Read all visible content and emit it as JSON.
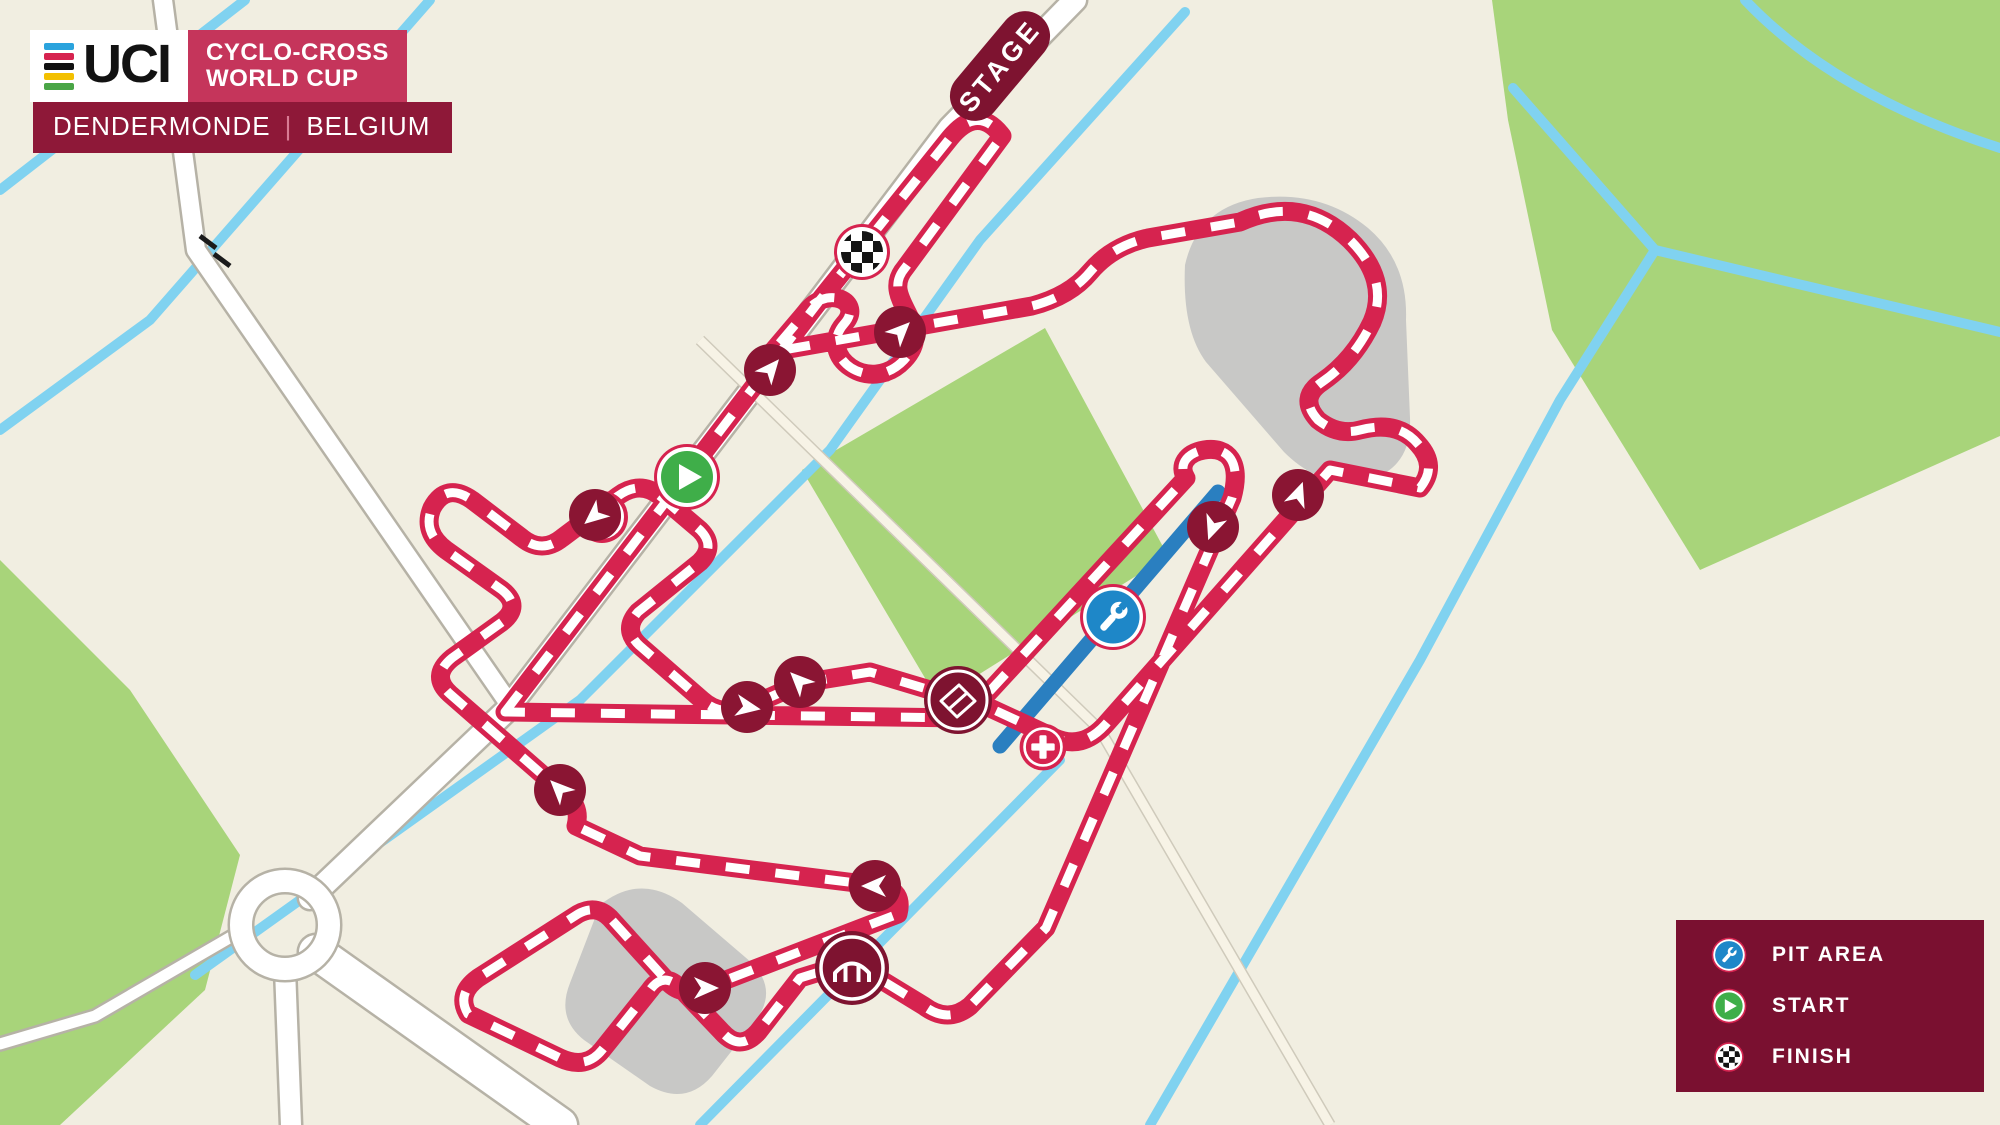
{
  "header": {
    "uci": "UCI",
    "series_line1": "CYCLO-CROSS",
    "series_line2": "WORLD CUP",
    "location": "DENDERMONDE",
    "separator": "|",
    "country": "BELGIUM",
    "stripe_colors": [
      "#2aa3dd",
      "#d6234f",
      "#111111",
      "#f3c000",
      "#4aa546"
    ]
  },
  "stage_label": "STAGE",
  "legend": {
    "items": [
      {
        "icon": "pit-area-icon",
        "type": "pit",
        "label": "PIT AREA"
      },
      {
        "icon": "start-icon",
        "type": "start",
        "label": "START"
      },
      {
        "icon": "finish-icon",
        "type": "finish",
        "label": "FINISH"
      }
    ]
  },
  "colors": {
    "bg": "#f1eee1",
    "field": "#a8d47a",
    "water": "#80d2f0",
    "sand": "#c8c8c6",
    "road_fill": "#ffffff",
    "road_casing": "#b6b2a6",
    "path_fill": "#f7f3e6",
    "path_casing": "#cfcabb",
    "course": "#d6234f",
    "course_dash": "#ffffff",
    "pit_lane": "#2a7fc0",
    "pit_icon": "#1e87c8",
    "start_green": "#3fae49",
    "dark": "#7e1330",
    "arrow_bg": "#8a1533",
    "header_red": "#c5355b",
    "header_maroon": "#8e1838",
    "legend_bg": "#7a1030",
    "crossing": "#1a1a1a"
  },
  "map": {
    "green_areas": [
      "M 1492,0 L 2000,0 L 2000,436 L 1700,570 L 1552,330 L 1508,120 Z",
      "M 1045,328 L 1168,556 L 938,700 L 802,470 Z",
      "M 0,560 L 130,690 L 240,855 L 205,990 L 60,1125 L 0,1125 Z"
    ],
    "gray_areas": [
      "M 1185,265 Q 1198,207 1258,198 Q 1322,190 1368,228 Q 1408,262 1406,320 L 1410,418 Q 1412,468 1368,480 Q 1322,490 1284,452 L 1206,362 Q 1182,330 1185,265 Z",
      "M 600,905 Q 640,873 682,903 L 752,963 Q 778,990 756,1020 L 712,1076 Q 686,1106 650,1086 L 584,1040 Q 556,1018 570,983 Z"
    ],
    "waterways": [
      "M 245,0 L 0,190",
      "M 430,0 L 150,320 L 0,430",
      "M 1185,12 L 980,240 L 830,450 L 580,700 L 195,975",
      "M 1513,88 L 1655,250 L 2000,332",
      "M 1655,250 L 1560,400 L 1420,660 L 1150,1125",
      "M 1060,760 L 700,1125",
      "M 1745,0 Q 1835,95 2000,148"
    ],
    "roads": [
      {
        "d": "M 1075,0 L 950,128 L 820,300 L 505,712 L 310,898",
        "w": 22
      },
      {
        "d": "M 163,0 L 196,250 L 510,705",
        "w": 18
      },
      {
        "d": "M 285,969 L 291,1125",
        "w": 20
      },
      {
        "d": "M 316,952 L 560,1125",
        "w": 34
      },
      {
        "d": "M 243,930 L 95,1016 L 0,1044",
        "w": 11
      }
    ],
    "faint_paths": [
      {
        "d": "M 700,340 L 1100,730 L 1330,1125",
        "w": 9
      }
    ],
    "roundabout": {
      "cx": 285,
      "cy": 925,
      "r": 44
    },
    "level_crossing": [
      "M 200,236 L 216,248",
      "M 214,254 L 230,266"
    ],
    "pit_lane": "M 1218,492 L 1000,746",
    "course": "M 505,712 L 820,300 L 950,138 Q 978,104 1002,136 L 905,268 C 878,300 938,324 904,360 C 870,396 816,356 844,324 C 864,302 828,284 806,312 L 772,352 L 1032,306 Q 1070,296 1090,272 Q 1112,246 1148,238 L 1240,222 Q 1302,194 1350,240 Q 1390,280 1372,322 Q 1354,360 1322,382 Q 1298,398 1318,420 Q 1338,436 1360,430 Q 1398,420 1418,444 Q 1438,466 1420,488 L 1330,470 L 1105,725 Q 1082,750 1055,738 L 990,708 L 870,672 L 802,683 L 750,706 Q 722,718 702,700 L 640,646 Q 622,630 638,612 L 700,562 Q 716,546 700,530 L 660,496 Q 640,480 618,496 L 562,538 Q 542,554 522,538 L 472,500 Q 446,482 432,508 Q 422,532 446,550 L 502,590 Q 522,606 502,622 L 452,658 Q 430,676 450,694 L 560,790 Q 582,804 576,826 L 640,856 L 880,886 Q 904,890 898,914 L 705,988 Q 682,997 668,982 L 610,918 Q 596,904 578,914 L 478,978 Q 456,994 468,1014 L 560,1058 Q 586,1070 602,1050 L 650,990 Q 664,970 682,990 L 722,1032 Q 740,1052 758,1032 L 800,978 L 852,962 L 924,1006 Q 948,1024 970,1006 L 1046,928 L 1232,498 C 1242,462 1228,446 1204,450 C 1186,453 1178,466 1186,478 L 965,718 L 505,712 Z",
    "icons": [
      {
        "type": "stage",
        "x": 1000,
        "y": 66,
        "rot": -50,
        "label": "STAGE"
      },
      {
        "type": "finish",
        "x": 862,
        "y": 252
      },
      {
        "type": "start",
        "x": 687,
        "y": 477
      },
      {
        "type": "medical",
        "x": 602,
        "y": 517,
        "scale": 1.0
      },
      {
        "type": "medical",
        "x": 1043,
        "y": 747,
        "scale": 0.9
      },
      {
        "type": "pit",
        "x": 1113,
        "y": 617
      },
      {
        "type": "planks",
        "x": 958,
        "y": 700
      },
      {
        "type": "bridge",
        "x": 852,
        "y": 968
      },
      {
        "type": "arrow",
        "x": 770,
        "y": 370,
        "rot": 40
      },
      {
        "type": "arrow",
        "x": 900,
        "y": 332,
        "rot": 45
      },
      {
        "type": "arrow",
        "x": 1213,
        "y": 527,
        "rot": 200
      },
      {
        "type": "arrow",
        "x": 1298,
        "y": 495,
        "rot": 20
      },
      {
        "type": "arrow",
        "x": 595,
        "y": 515,
        "rot": 230
      },
      {
        "type": "arrow",
        "x": 800,
        "y": 682,
        "rot": 315
      },
      {
        "type": "arrow",
        "x": 747,
        "y": 707,
        "rot": 100
      },
      {
        "type": "arrow",
        "x": 560,
        "y": 790,
        "rot": 315
      },
      {
        "type": "arrow",
        "x": 875,
        "y": 886,
        "rot": 270
      },
      {
        "type": "arrow",
        "x": 705,
        "y": 988,
        "rot": 90
      }
    ]
  }
}
